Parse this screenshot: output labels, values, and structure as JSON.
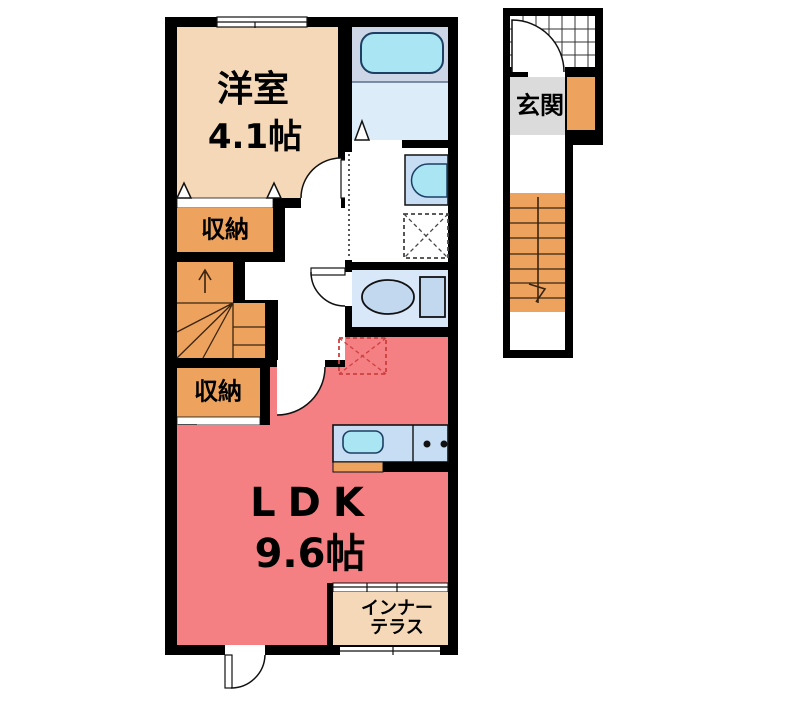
{
  "plan": {
    "type": "apartment-floor-plan",
    "floor_unit": "2F one-bedroom unit with separate entrance stairwell"
  },
  "rooms": {
    "western": {
      "name": "洋室",
      "size": "4.1帖"
    },
    "storage_upper": {
      "label": "収納"
    },
    "storage_lower": {
      "label": "収納"
    },
    "entrance": {
      "label": "玄関"
    },
    "ldk": {
      "name": "LDK",
      "size": "9.6帖"
    },
    "terrace": {
      "line1": "インナー",
      "line2": "テラス"
    }
  },
  "fixtures": [
    "bathtub-icon",
    "washbasin-icon",
    "washing-machine-space-icon",
    "toilet-icon",
    "kitchen-sink-icon",
    "stove-burners-icon",
    "refrigerator-space-icon",
    "winder-staircase-icon",
    "entrance-staircase-icon",
    "entry-tile-grid-icon"
  ],
  "colors": {
    "wall_black": "#000000",
    "room_beige": "#f4d8b8",
    "storage_orange": "#eda35e",
    "ldk_pink": "#f58083",
    "entrance_gray": "#dbdbdb",
    "bath_upper_blue": "#ccd6e7",
    "bath_lower_blue": "#dcecf8",
    "fixture_cyan": "#a9e5f2",
    "sanitary_blue": "#d8e8f8",
    "fixture_blue": "#c2d8ee",
    "counter_blue": "#c7ddf3",
    "fridge_dash_red": "#cc4040",
    "line_dark": "#111111"
  }
}
